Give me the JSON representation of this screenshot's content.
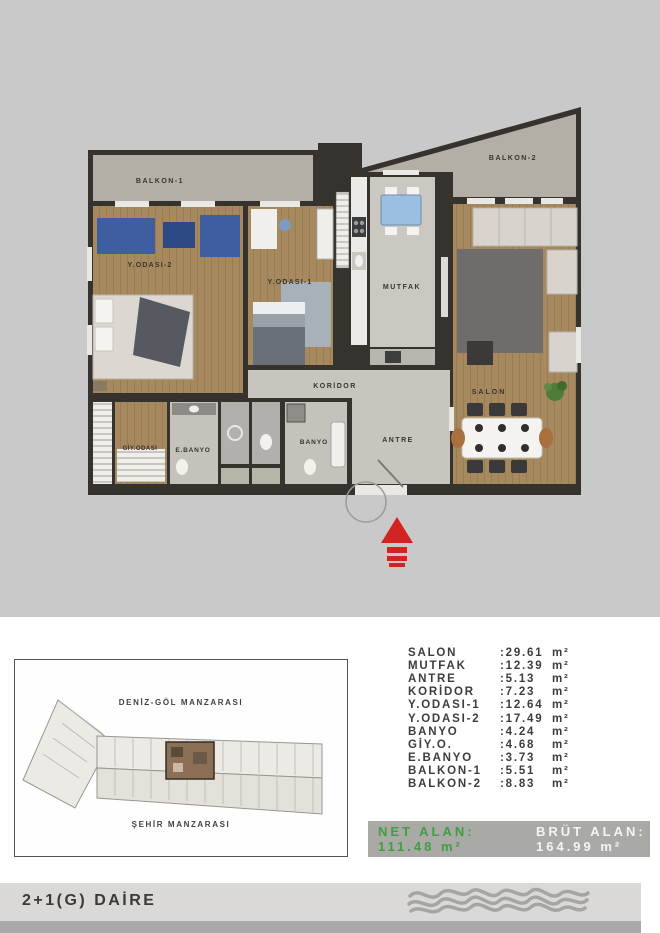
{
  "plan": {
    "room_labels": {
      "balkon1": "BALKON-1",
      "balkon2": "BALKON-2",
      "y_odasi_2": "Y.ODASI-2",
      "y_odasi_1": "Y.ODASI-1",
      "mutfak": "MUTFAK",
      "koridor": "KORİDOR",
      "salon": "SALON",
      "antre": "ANTRE",
      "banyo": "BANYO",
      "e_banyo": "E.BANYO",
      "giy_odasi": "GİY.ODASI"
    }
  },
  "keyplan": {
    "top_view_label": "DENİZ-GÖL MANZARASI",
    "bottom_view_label": "ŞEHİR MANZARASI"
  },
  "area_table": {
    "unit": "m²",
    "rows": [
      {
        "name": "SALON",
        "value": ":29.61"
      },
      {
        "name": "MUTFAK",
        "value": ":12.39"
      },
      {
        "name": "ANTRE",
        "value": ":5.13"
      },
      {
        "name": "KORİDOR",
        "value": ":7.23"
      },
      {
        "name": "Y.ODASI-1",
        "value": ":12.64"
      },
      {
        "name": "Y.ODASI-2",
        "value": ":17.49"
      },
      {
        "name": "BANYO",
        "value": ":4.24"
      },
      {
        "name": "GİY.O.",
        "value": ":4.68"
      },
      {
        "name": "E.BANYO",
        "value": ":3.73"
      },
      {
        "name": "BALKON-1",
        "value": ":5.51"
      },
      {
        "name": "BALKON-2",
        "value": ":8.83"
      }
    ]
  },
  "totals": {
    "net_label": "NET ALAN:",
    "net_value": "111.48 m²",
    "brut_label": "BRÜT ALAN:",
    "brut_value": "164.99 m²"
  },
  "footer": {
    "apartment_type": "2+1(G) DAİRE"
  },
  "colors": {
    "net_green": "#3f9e42",
    "arrow_red": "#d42222",
    "panel_gray": "#c9c9c9",
    "totals_bar_gray": "#a9a9a6"
  }
}
